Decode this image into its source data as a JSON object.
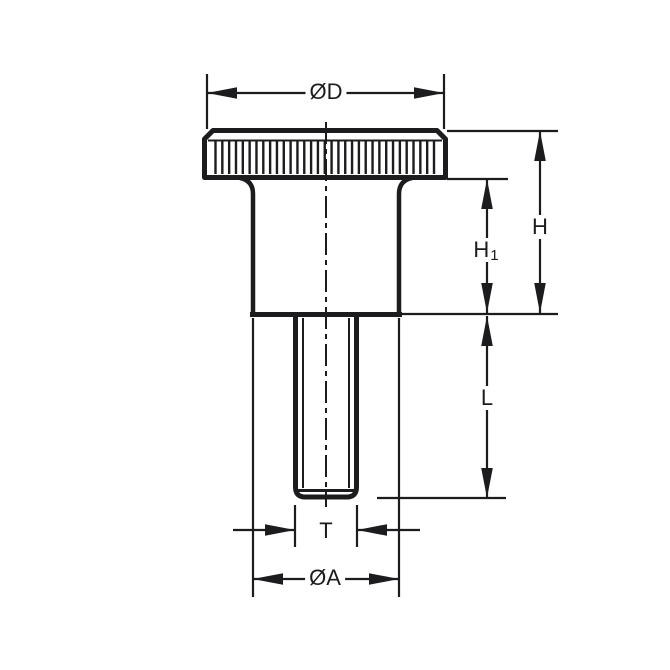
{
  "drawing": {
    "title": "Knurled thumb knob dimensional drawing",
    "labels": {
      "head_diameter": "ØD",
      "total_height": "H",
      "upper_height_main": "H",
      "upper_height_sub": "1",
      "thread_length": "L",
      "thread_diameter": "T",
      "hub_diameter": "ØA"
    },
    "colors": {
      "line": "#1c1c1f",
      "background": "#ffffff"
    },
    "knurl": {
      "stripe_count": 33
    }
  }
}
